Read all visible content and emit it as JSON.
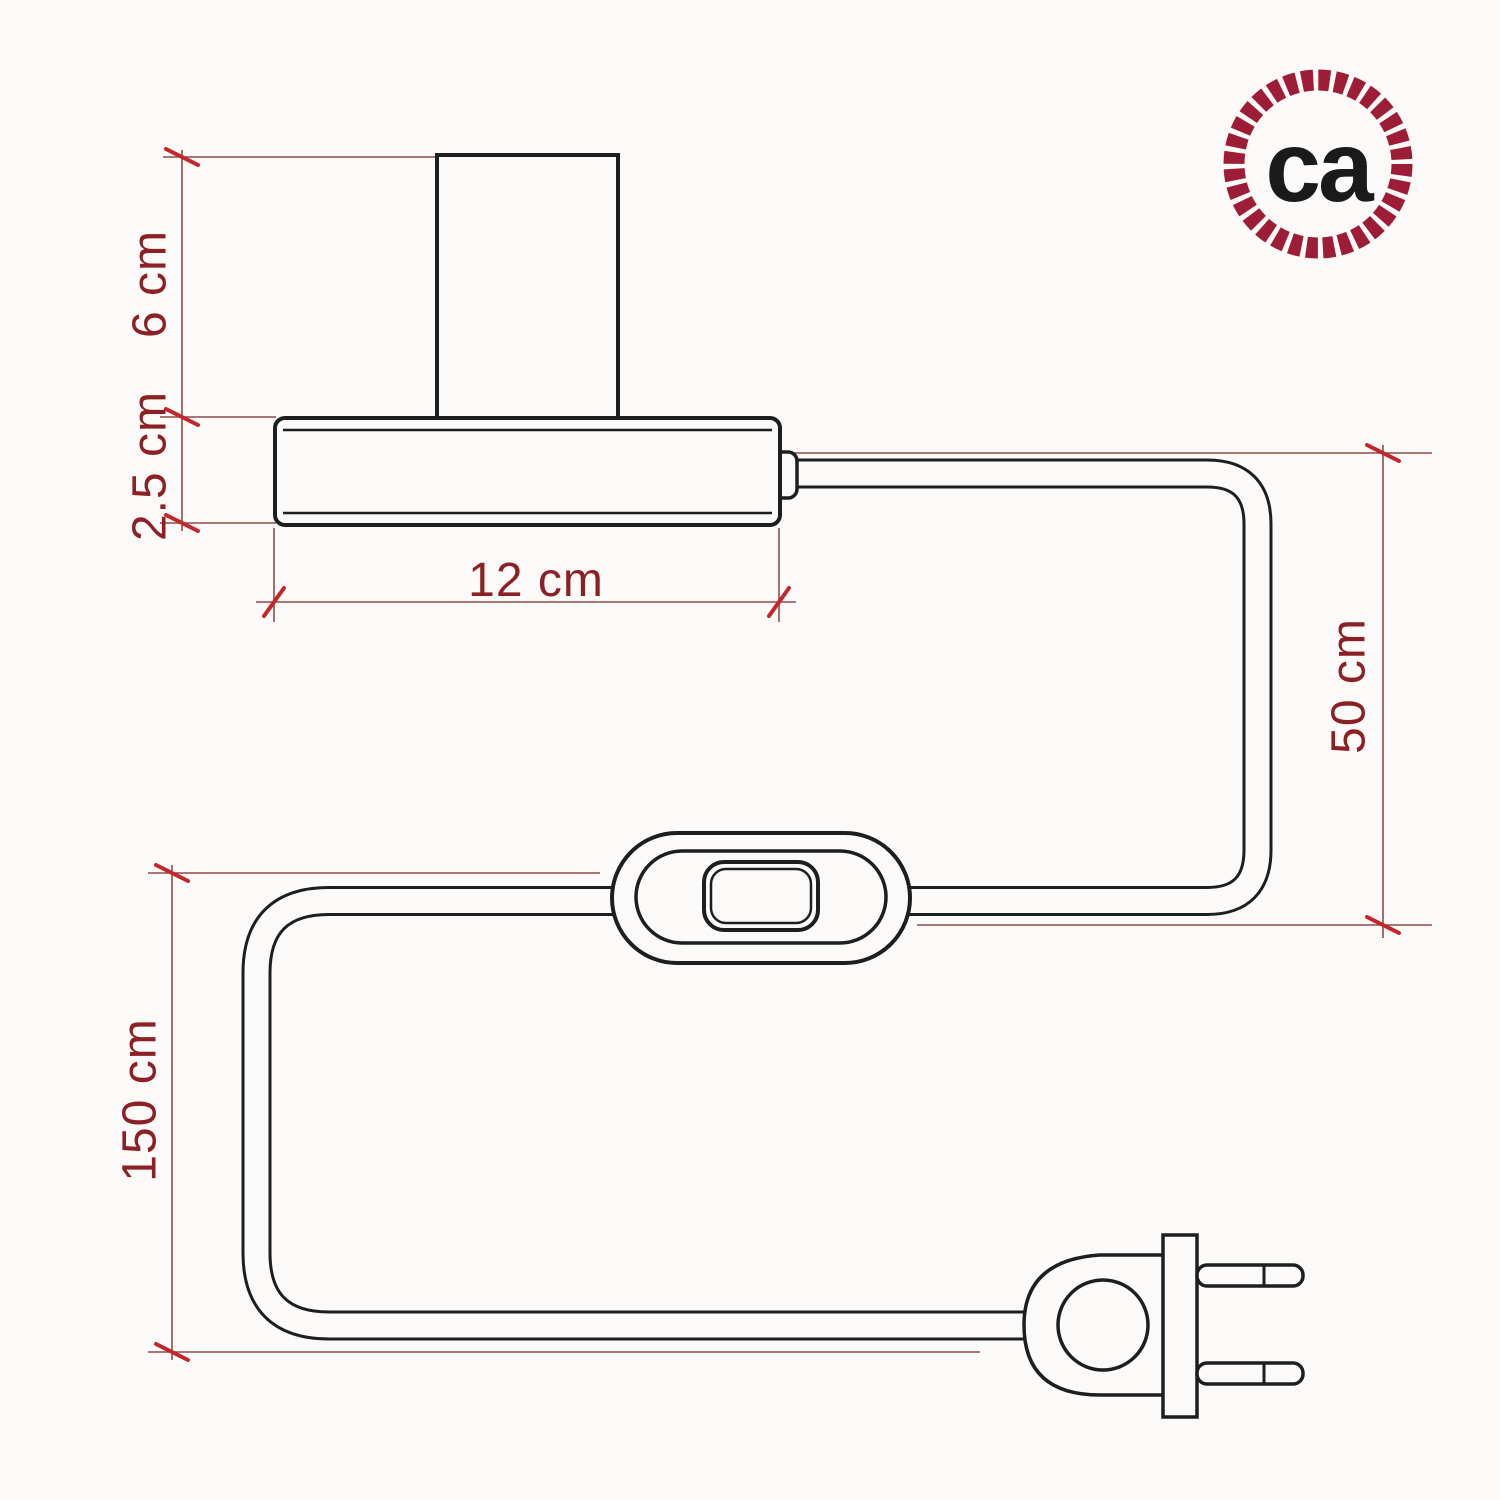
{
  "title": "Table lamp technical dimension drawing",
  "drawing": {
    "subject": "table lamp with lamp holder, base, power cable, inline switch and two-prong plug",
    "style": "line drawing with architectural dimension lines",
    "ink_color": "#1e1e1e",
    "dimension_line_color": "#8f4a4a",
    "tick_color": "#c4272b",
    "dimension_text_color": "#8c2125",
    "background_color": "#fbfaf9"
  },
  "dimensions": {
    "holder_height": "6 cm",
    "base_height": "2.5 cm",
    "base_width": "12 cm",
    "cable_base_to_switch": "50 cm",
    "cable_switch_to_plug": "150 cm"
  },
  "logo": {
    "text": "ca",
    "ring_color": "#9e1d36",
    "text_color": "#1a1a1a"
  }
}
